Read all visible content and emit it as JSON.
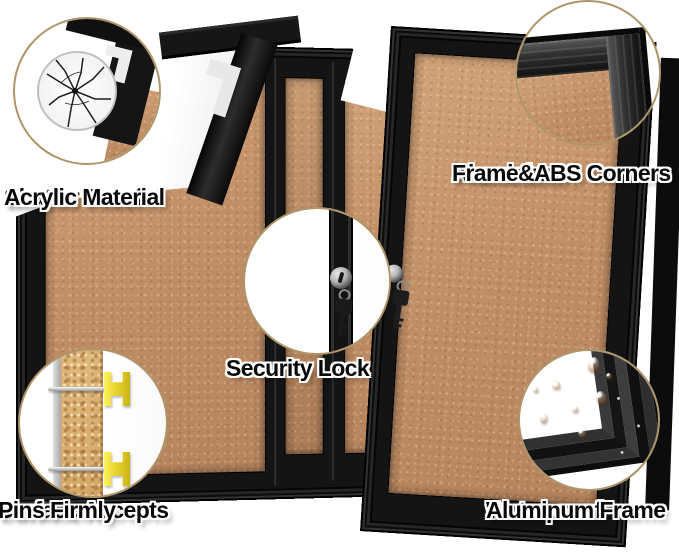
{
  "image_type": "product feature infographic",
  "product": {
    "name": "Enclosed cork bulletin board with locking black aluminum doors",
    "colors": {
      "background": "#ffffff",
      "cork": "#c59a72",
      "cork_light": "#d2a379",
      "frame_black": "#141414",
      "frame_gray": "#3a3a3a",
      "callout_ring": "#ae9569",
      "pin_yellow": "#e8d52e",
      "key_metal": "#b5b5b5",
      "label_text": "#0a0a0a",
      "label_outline": "#ffffff"
    }
  },
  "callouts": {
    "shatter": {
      "line1": "Shatter Proof",
      "line2": "Acrylic Material",
      "icon": "shattered-glass-icon"
    },
    "aluminium": {
      "line1": "Aluminium",
      "line2": "Frame&ABS Corners",
      "icon": "frame-corner-icon"
    },
    "security": {
      "line1": "Security Lock",
      "icon": "lock-and-key-icon"
    },
    "pins": {
      "line1": "Surface Accepts",
      "line2": "Pins Firmly",
      "icon": "pushpin-icon"
    },
    "water": {
      "line1": "Waterproof",
      "line2": "Aluminum Frame",
      "icon": "water-drops-icon"
    }
  }
}
